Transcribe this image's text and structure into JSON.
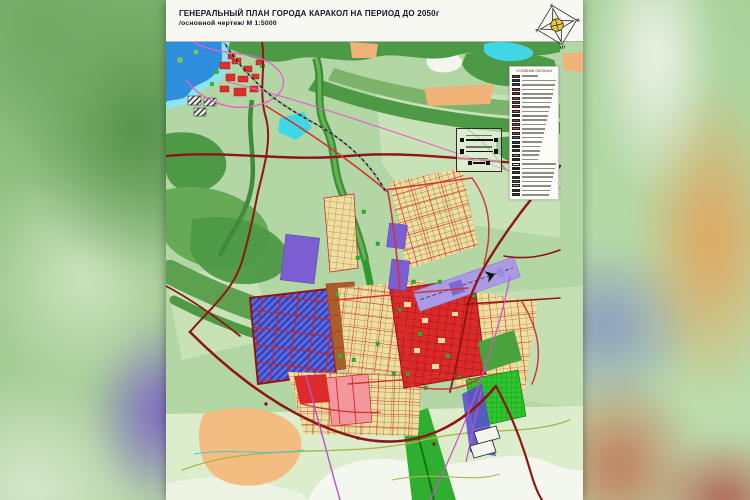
{
  "header": {
    "title": "ГЕНЕРАЛЬНЫЙ ПЛАН ГОРОДА КАРАКОЛ НА ПЕРИОД ДО 2050г",
    "subtitle": "/основной чертеж/  М 1:5000"
  },
  "compass": {
    "north": "С",
    "east": "В",
    "south": "Ю",
    "west": "З"
  },
  "legend": {
    "heading": "УСЛОВНЫЕ ОБОЗНАЧЕНИЯ",
    "items": [
      {
        "color": "#b22222",
        "label": ""
      },
      {
        "color": "#3b2f63",
        "label": ""
      },
      {
        "color": "#27418c",
        "label": ""
      },
      {
        "color": "#c33a2e",
        "label": ""
      },
      {
        "color": "#7e3322",
        "label": ""
      },
      {
        "color": "#c03535",
        "label": ""
      },
      {
        "color": "#5a5a5a",
        "label": ""
      },
      {
        "color": "#aa2d2d",
        "label": ""
      },
      {
        "color": "#cc4444",
        "label": ""
      },
      {
        "color": "#2e2e2e",
        "label": ""
      },
      {
        "color": "#8a4a28",
        "label": ""
      },
      {
        "color": "#c43a3a",
        "label": ""
      },
      {
        "color": "#b85050",
        "label": ""
      },
      {
        "color": "#6b4aa0",
        "label": ""
      },
      {
        "color": "#4a5cb8",
        "label": ""
      },
      {
        "color": "#283c90",
        "label": ""
      },
      {
        "color": "#1c1c1c",
        "label": ""
      },
      {
        "color": "#3c3c3c",
        "label": ""
      },
      {
        "color": "#8f9436",
        "label": ""
      },
      {
        "color": "#2a2a2a",
        "label": ""
      },
      {
        "color": "#f2f2f2",
        "label": ""
      },
      {
        "color": "#141414",
        "label": ""
      },
      {
        "color": "#464646",
        "label": ""
      },
      {
        "color": "#343434",
        "label": ""
      },
      {
        "color": "#5c5c5c",
        "label": ""
      },
      {
        "color": "#9aa342",
        "label": ""
      },
      {
        "color": "#303030",
        "label": ""
      },
      {
        "color": "#5a3a26",
        "label": ""
      }
    ]
  },
  "palette": {
    "land": "#b3d6a5",
    "forest": "#4d9946",
    "water": "#2e8ede",
    "pond": "#3fd7e6",
    "residential_blocks": "#f1dd9c",
    "new_residential_hatch": "#5f6cdb",
    "city_center": "#dc2a2a",
    "industrial_purple": "#7b5ed1",
    "airport_runway": "#ab9ae4",
    "park_green": "#2fc52f",
    "major_road": "#8e1616",
    "street_red": "#d23232",
    "planned_road_magenta": "#ea5ccc",
    "railway": "#1a1a1a",
    "orchard_orange": "#efb277"
  }
}
